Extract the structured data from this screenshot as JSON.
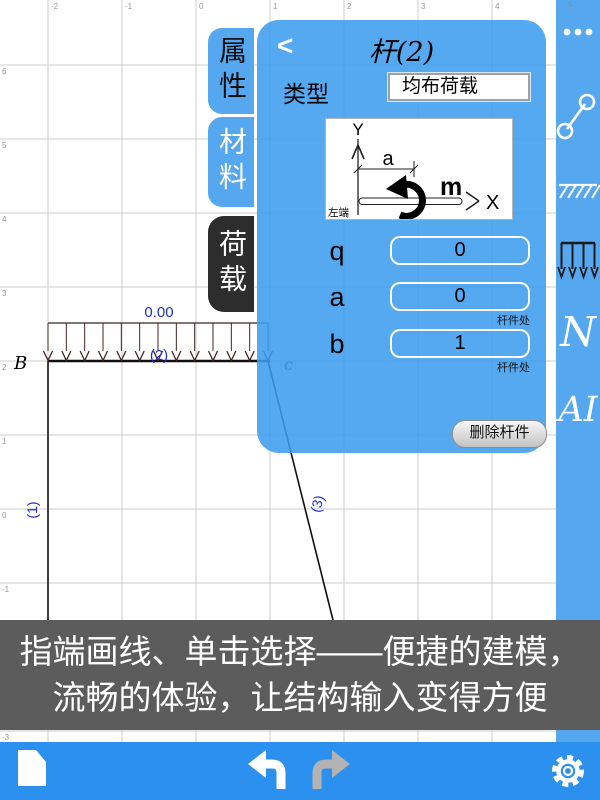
{
  "canvas": {
    "grid": {
      "top_labels": [
        "-2",
        "-1",
        "0",
        "1",
        "2",
        "3",
        "4",
        "5"
      ],
      "left_labels": [
        "6",
        "5",
        "4",
        "3",
        "2",
        "1",
        "0",
        "-1",
        "-2",
        "-3"
      ]
    },
    "structure": {
      "node_b": "B",
      "node_c": "c",
      "load_value": "0.00",
      "member_1": "(1)",
      "member_2": "(2)",
      "member_3": "(3)"
    }
  },
  "tabs": {
    "properties": "属性",
    "material": "材料",
    "load": "荷载"
  },
  "panel": {
    "back": "<",
    "title": "杆(2)",
    "type_label": "类型",
    "type_value": "均布荷载",
    "diagram": {
      "y_axis": "Y",
      "x_axis": "X",
      "dim_a": "a",
      "moment": "m",
      "left_end": "左端"
    },
    "fields": {
      "q": {
        "label": "q",
        "value": "0"
      },
      "a": {
        "label": "a",
        "value": "0",
        "note": "杆件处"
      },
      "b": {
        "label": "b",
        "value": "1",
        "note": "杆件处"
      }
    },
    "delete_button": "删除杆件"
  },
  "sidebar": {
    "n_tool": "N",
    "ai_tool": "AI"
  },
  "banner": {
    "line1": "指端画线、单击选择——便捷的建模，",
    "line2": "流畅的体验，让结构输入变得方便"
  },
  "colors": {
    "panel_blue": "#55a8f0",
    "toolbar_blue": "#2b90ee",
    "active_tab_dark": "#2d2d2d",
    "banner_gray": "#5c5c5c",
    "label_blue": "#1e2ed6",
    "load_arrow": "#42251f"
  }
}
